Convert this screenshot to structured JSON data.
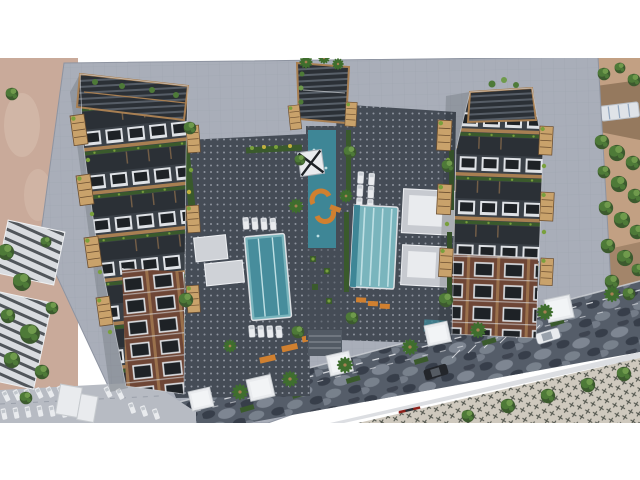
{
  "meta": {
    "type": "architectural-aerial-render",
    "description": "Top-down 3D architectural rendering of a residential complex: two dark balconied apartment wings around landscaped courtyards with swimming pools, a central water-feature spine with orange benches, a large tiled plaza, a dark cobblestone street with cars at bottom right, neighboring buildings, parking and trees on the left, and tree-lined grounds on the right.",
    "canvas": {
      "width": 640,
      "height": 480
    },
    "margins": {
      "white_top_px": 58,
      "white_bottom_from_px": 423
    }
  },
  "scene": {
    "colors": {
      "plaza": "#a9aeb9",
      "plazaLine": "#959ba8",
      "plazaEdge": "#8e94a1",
      "groundLeft": "#c9aa9a",
      "groundLeftBlob": "#dac2b2",
      "groundRight": "#c2a083",
      "groundBand": "#8a6f55",
      "treeDark": "#3c5a2e",
      "treeMid": "#4e7a38",
      "treeLight": "#6f9a4c",
      "palmGreen": "#3f6e2e",
      "roadBase": "#555d69",
      "roadDark": "#343b46",
      "roadLight": "#8e96a2",
      "laneMark": "#e8eaee",
      "sidewalk": "#b7bbc3",
      "curb": "#dcdee2",
      "paver": "#cfc9be",
      "paverMark": "#383d36",
      "deck": "#454c56",
      "deckDot": "#d6dadf",
      "deckLight": "#9aa0ab",
      "facadeDark": "#2b3036",
      "facadeMid": "#3a4047",
      "frameWhite": "#dfe2e6",
      "windowDark": "#1e2226",
      "wood": "#a87f52",
      "pod": "#c9a26b",
      "podLine": "#6b4e30",
      "brick": "#6e4636",
      "hedge": "#3a5a2c",
      "shrub": "#79a03c",
      "shrubYellow": "#c2b13e",
      "poolDeep": "#3e8696",
      "poolLight": "#7ab5bd",
      "poolLane": "#bfe0e4",
      "orange": "#d08030",
      "carWhite": "#e9ebee",
      "carDark": "#23262b",
      "carRed": "#8e211b",
      "neighborWall": "#d9dce0",
      "neighborStripe": "#3a3e44",
      "vehicleRoof": "#dfe3e8",
      "shadow": "rgba(26,29,34,0.16)"
    },
    "elements": {
      "buildings": [
        {
          "name": "left-residential-wing",
          "style": "dark facade, white window frames, wood trim, roof pergola, tan balcony pods, brick lower floors"
        },
        {
          "name": "right-residential-wing",
          "style": "dark facade, white window frames, roof pergola, tan balcony pods, brick lower floors"
        },
        {
          "name": "central-core-pavilion",
          "style": "louvered pergola over entry core with water-feature spine"
        }
      ],
      "pools": [
        {
          "name": "left-courtyard-lap-pool"
        },
        {
          "name": "right-courtyard-pool",
          "lanes": 4
        },
        {
          "name": "upper-narrow-lap-pool"
        }
      ],
      "courtyards": [
        {
          "name": "left-courtyard",
          "features": [
            "dotted amenity deck",
            "cabana roofs",
            "sun loungers",
            "hedges"
          ]
        },
        {
          "name": "right-courtyard",
          "features": [
            "dotted amenity deck",
            "two pavilion roofs",
            "sun loungers",
            "orange loungers",
            "hedges"
          ]
        }
      ],
      "spine": {
        "name": "central-water-spine",
        "features": [
          "teal watercourse",
          "orange curved benches",
          "x-braced skylight",
          "planters",
          "steps"
        ]
      },
      "road": {
        "name": "cobblestone-street",
        "vehicles": [
          {
            "type": "car",
            "color": "dark-gray"
          },
          {
            "type": "suv",
            "color": "white"
          },
          {
            "type": "car",
            "color": "white"
          },
          {
            "type": "car",
            "color": "red"
          }
        ],
        "lane_dashes": true,
        "angled_parking_ticks": 6
      },
      "parking": {
        "location": "bottom-left",
        "parked_cars_approx": 17
      },
      "neighbors": {
        "left_buildings": 2,
        "left_trees_approx": 10,
        "right_tree_band_trees_approx": 17,
        "right_vehicle_roof": 1
      },
      "street_furniture": {
        "white_entrance_canopies": 5,
        "kiosk_boxes": 2,
        "palm_trees_along_road": 7,
        "orange_benches": 3
      }
    }
  }
}
